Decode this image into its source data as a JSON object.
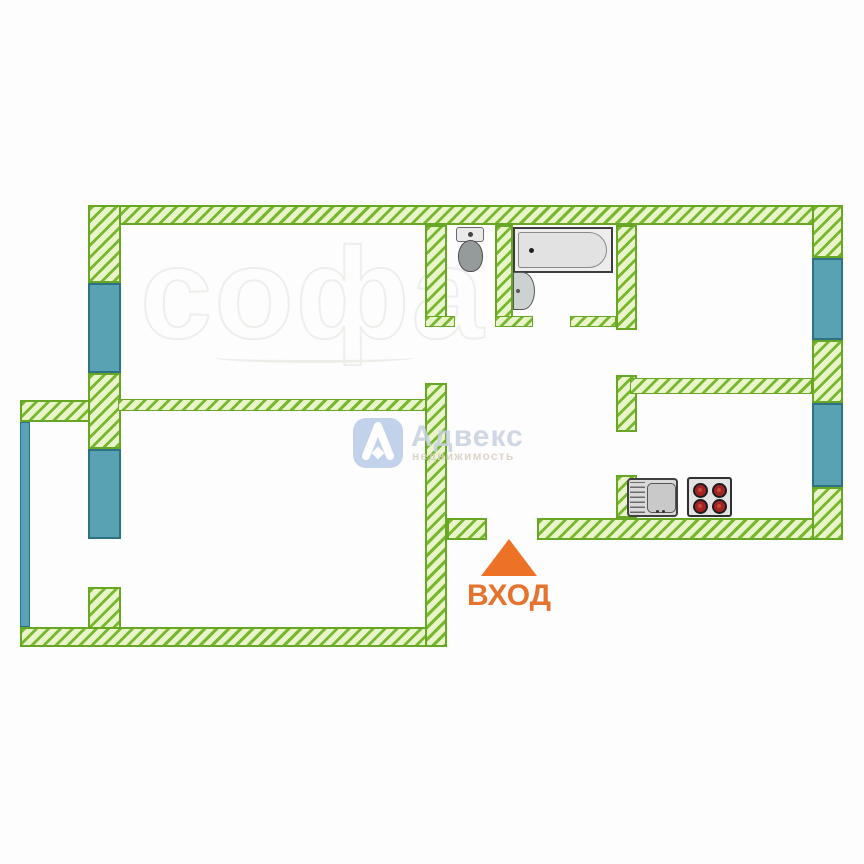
{
  "title": "apartment-floor-plan",
  "entrance": {
    "label": "ВХОД"
  },
  "watermark": {
    "brand": "Адвекс",
    "subtitle": "недвижимость"
  },
  "background_watermark": {
    "text": "софа"
  },
  "colors": {
    "wall_stripe": "#77b82e",
    "wall_fill": "#e9f4cb",
    "wall_border": "#68a625",
    "window_fill": "#58a2b3",
    "window_border": "#2e7185",
    "entrance_orange": "#ed7226",
    "entrance_text": "#e5722d",
    "burner_red": "#a32424",
    "fixture_gray": "#e6e6e6",
    "logo_blue": "#b9cbe9",
    "brand_text_color": "#c7d1e1",
    "subtitle_text_color": "#d8cfc2"
  },
  "icons": {
    "entrance_arrow": "up-triangle-icon",
    "logo": "adveks-lambda-logo-icon",
    "toilet": "toilet-icon",
    "bathtub": "bathtub-icon",
    "bathroom_sink": "sink-icon",
    "kitchen_sink": "kitchen-sink-icon",
    "stove": "stove-4-burner-icon"
  }
}
